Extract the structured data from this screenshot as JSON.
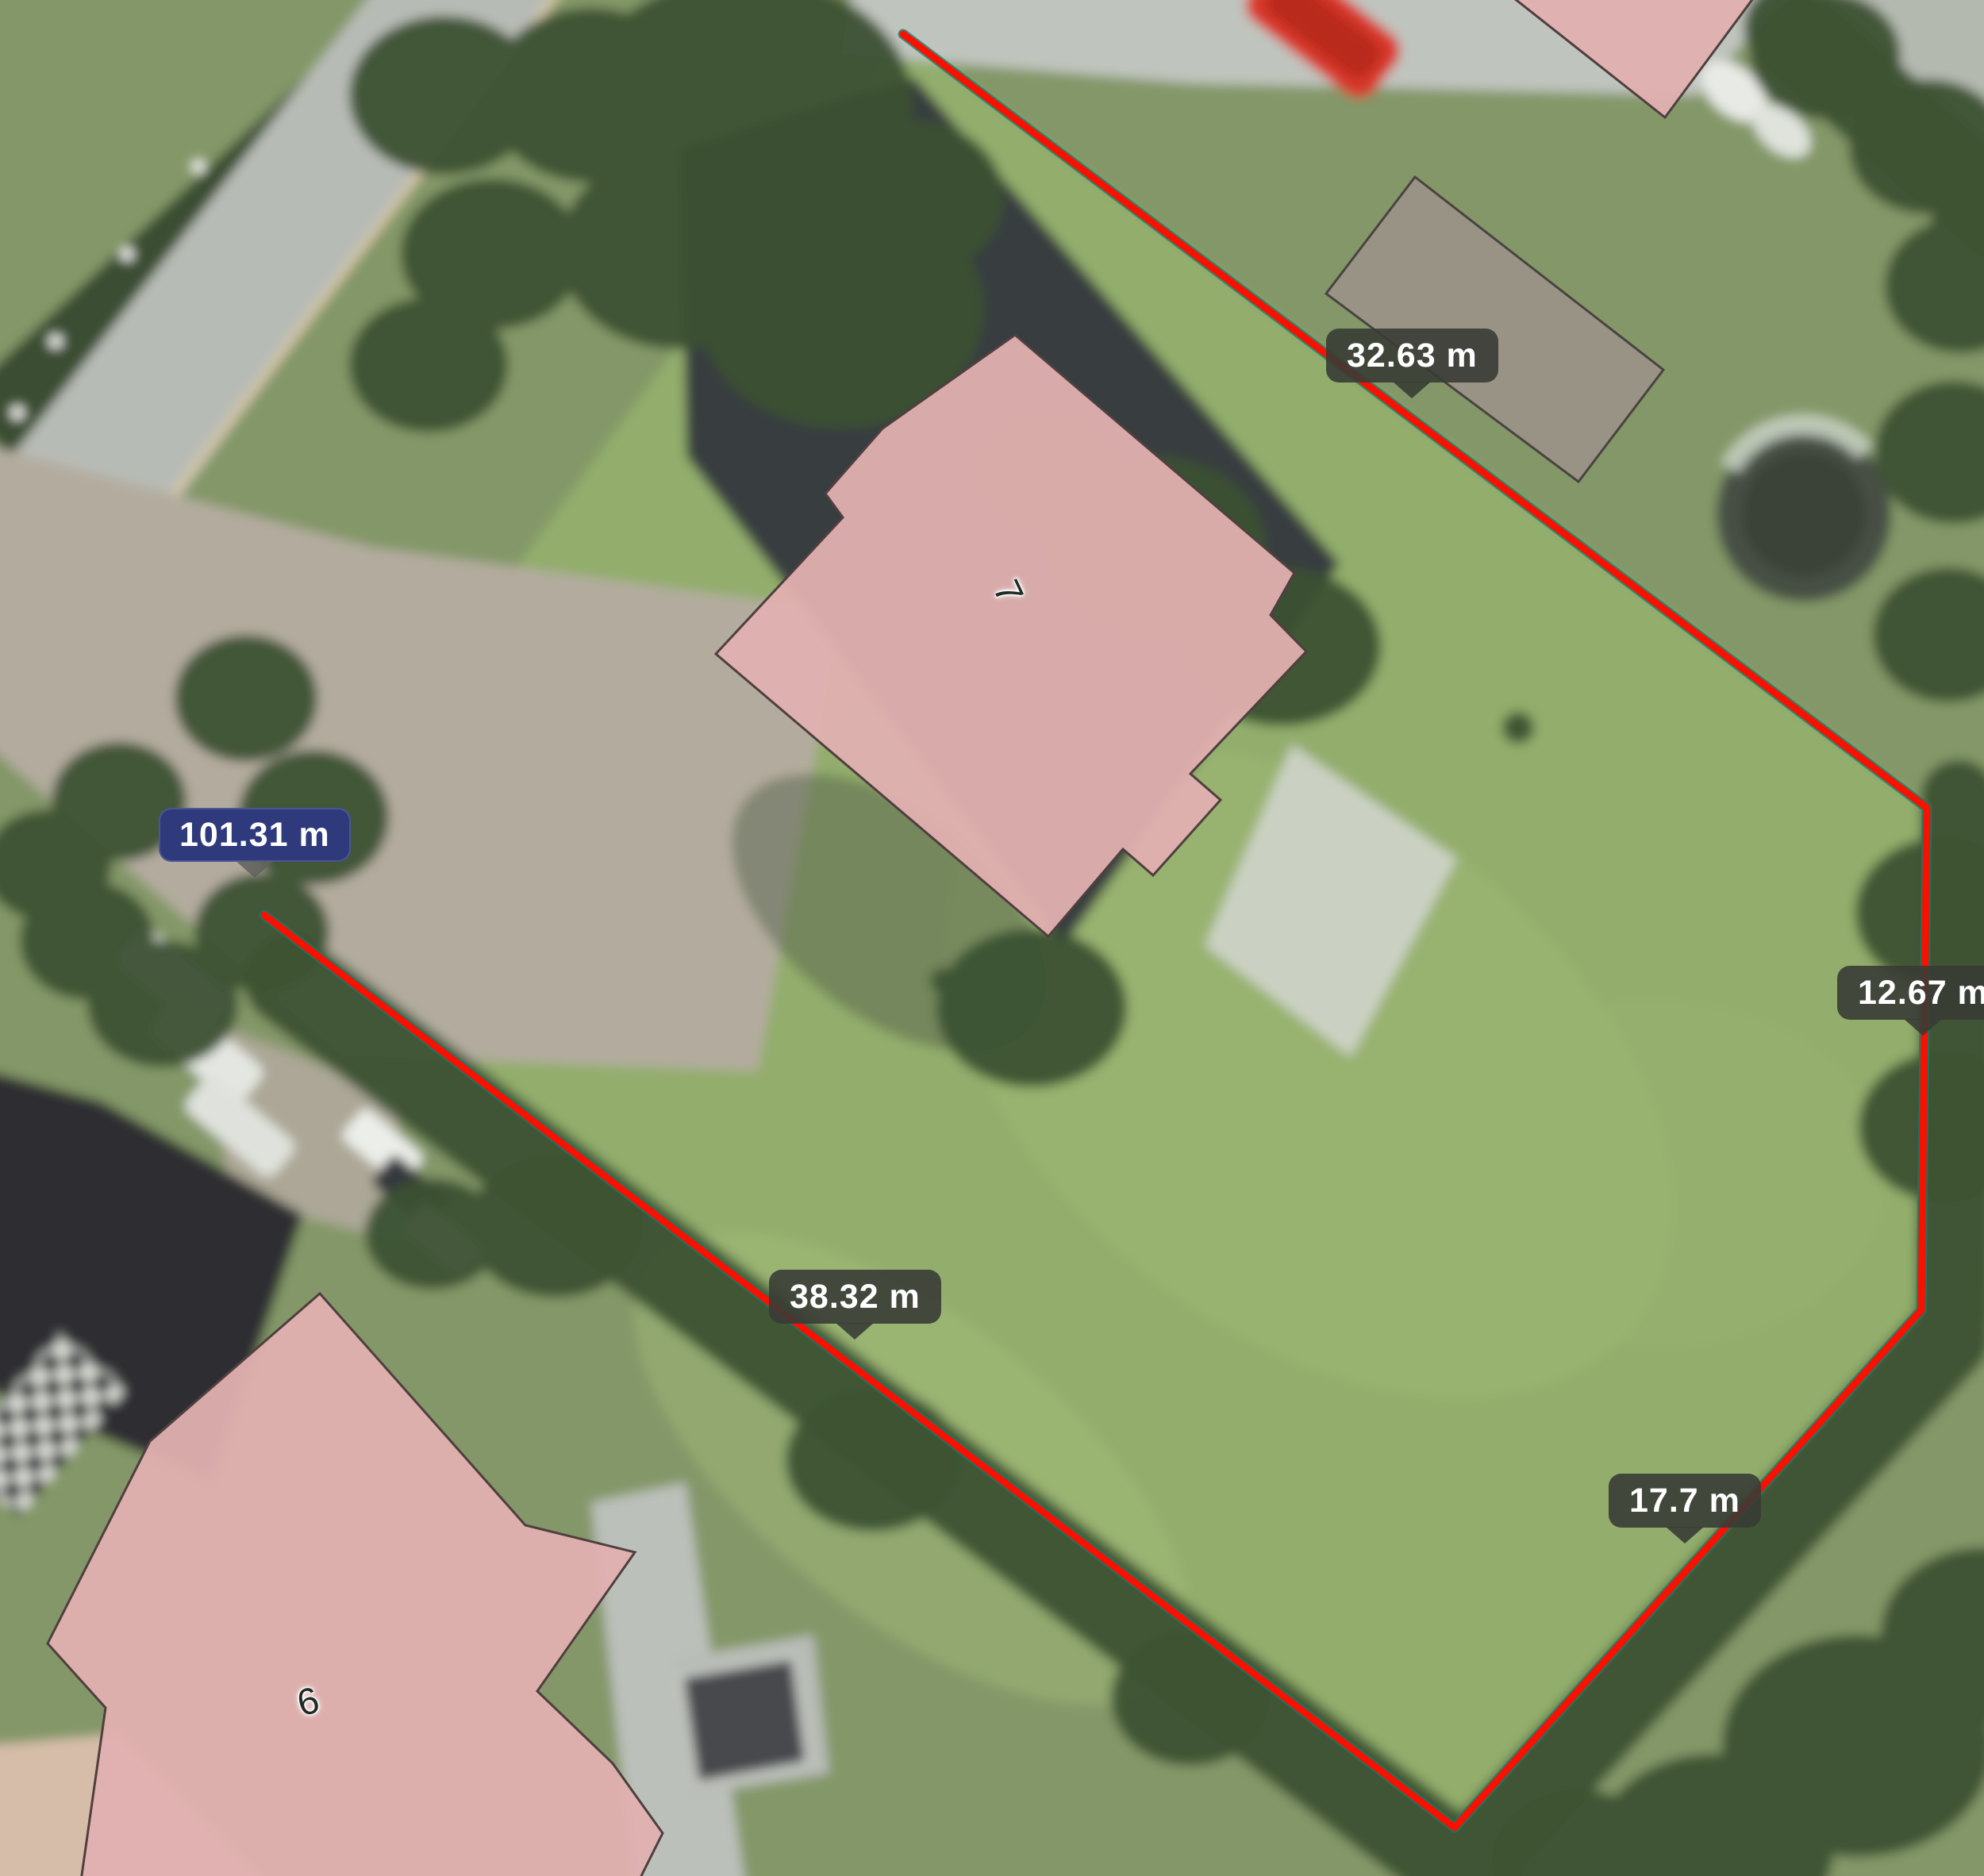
{
  "app": {
    "view": "aerial-satellite-map",
    "tool": "distance-measurement"
  },
  "measurements": {
    "unit": "m",
    "total": {
      "label": "101.31 m",
      "value_m": 101.31,
      "highlighted": true
    },
    "segments": [
      {
        "label": "32.63 m",
        "value_m": 32.63
      },
      {
        "label": "12.67 m",
        "value_m": 12.67
      },
      {
        "label": "17.7 m",
        "value_m": 17.7
      },
      {
        "label": "38.32 m",
        "value_m": 38.32
      }
    ]
  },
  "map": {
    "house_numbers": [
      {
        "label": "7"
      },
      {
        "label": "6"
      }
    ],
    "colors": {
      "measure_line_red": "#f71100",
      "measure_line_edge_teal": "#0a8070",
      "segment_label_bg": "#383c35",
      "total_label_bg": "#2f3a7d",
      "label_text": "#ffffff",
      "building_footprint_pink": "#e0b0b0",
      "shed_footprint_gray": "#9b9288",
      "footprint_outline": "#4f3f3f"
    }
  }
}
